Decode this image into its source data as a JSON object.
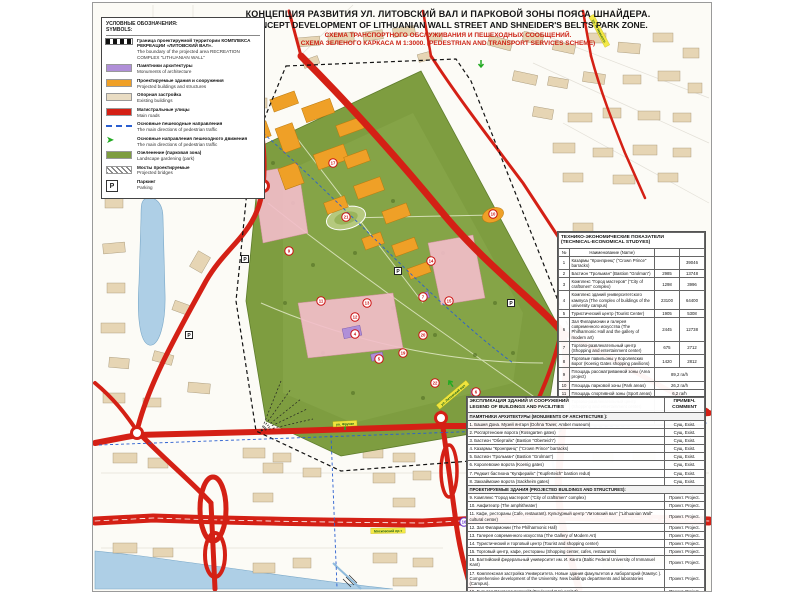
{
  "title": {
    "line1": "КОНЦЕПЦИЯ РАЗВИТИЯ УЛ. ЛИТОВСКИЙ ВАЛ И ПАРКОВОЙ ЗОНЫ ПОЯСА ШНАЙДЕРА.",
    "line2": "CONCEPT DEVELOPMENT OF LITHUANIAN WALL STREET AND SHNEIDER'S BELT'S PARK ZONE.",
    "line3": "СХЕМА ТРАНСПОРТНОГО ОБСЛУЖИВАНИЯ  И ПЕШЕХОДНЫХ  СООБЩЕНИЙ.",
    "line4": "СХЕМА ЗЕЛЕНОГО КАРКАСА  М 1:3000. (PEDESTRIAN AND TRANSPORT SERVICES SCHEME)"
  },
  "legend": {
    "header_ru": "УСЛОВНЫЕ ОБОЗНАЧЕНИЯ:",
    "header_en": "SYMBOLS:",
    "items": [
      {
        "type": "boundary",
        "ru": "Граница проектируемой территории КОМПЛЕКСА РЕКРЕАЦИИ «ЛИТОВСКИЙ ВАЛ».",
        "en": "The boundary of the projected area RECREATION COMPLEX \"LITHUANIAN WALL\""
      },
      {
        "type": "color",
        "color": "#b08fd8",
        "ru": "Памятники архитектуры",
        "en": "Monuments of architecture"
      },
      {
        "type": "color",
        "color": "#efa027",
        "ru": "Проектируемые здания и сооружения",
        "en": "Projected buildings and structures"
      },
      {
        "type": "color",
        "color": "#e9dcc3",
        "ru": "Опорная застройка",
        "en": "Existing buildings"
      },
      {
        "type": "color",
        "color": "#d42015",
        "ru": "Магистральные улицы",
        "en": "Main roads"
      },
      {
        "type": "bluedash",
        "ru": "Основные пешеходные направления",
        "en": "The main directions of pedestrian traffic"
      },
      {
        "type": "arrow",
        "ru": "Основные направления пешеходного движения",
        "en": "The main directions of pedestrian traffic"
      },
      {
        "type": "color",
        "color": "#7e9d40",
        "ru": "Озеленение (парковая зона)",
        "en": "Landscape gardening (park)"
      },
      {
        "type": "hatch",
        "ru": "Мосты проектируемые",
        "en": "Projected bridges"
      },
      {
        "type": "parking",
        "ru": "Паркинг",
        "en": "Parking"
      }
    ]
  },
  "tables": {
    "tech": {
      "title_ru": "ТЕХНИКО-ЭКОНОМИЧЕСКИЕ ПОКАЗАТЕЛИ",
      "title_en": "(TECHNICAL-ECONOMICAL STUDYES)",
      "col_num": "№",
      "col_name": "Наименование (Name)",
      "rows": [
        {
          "n": "1",
          "name": "Казармы \"Кронпринц\" (\"Crown Prince\" barracks)",
          "v1": "",
          "v2": "39046"
        },
        {
          "n": "2",
          "name": "Бастион \"Грольман\" (Bastion \"Grolman\")",
          "v1": "2985",
          "v2": "13748"
        },
        {
          "n": "3",
          "name": "Комплекс \"Город мастеров\" (\"City of craftsmen\" complex)",
          "v1": "1298",
          "v2": "3996"
        },
        {
          "n": "4",
          "name": "Комплекс зданий университетского кампуса (The complex of buildings of the university campus)",
          "v1": "23100",
          "v2": "64400"
        },
        {
          "n": "5",
          "name": "Туристический центр (Tourist Center)",
          "v1": "1905",
          "v2": "5308"
        },
        {
          "n": "6",
          "name": "Зал Филармонии и галерея современного искусства (The Philharmonic Hall and the gallery of modern art)",
          "v1": "2445",
          "v2": "12738"
        },
        {
          "n": "7",
          "name": "Торгово-развлекательный центр (Shopping and entertainment center)",
          "v1": "675",
          "v2": "2712"
        },
        {
          "n": "8",
          "name": "Торговые павильоны у Королевских ворот (Koenig Gates shopping pavilions)",
          "v1": "1420",
          "v2": "2812"
        },
        {
          "n": "9",
          "name": "Площадь рассматриваемой зоны (Area project)",
          "wide": true,
          "v2": "89,2 га/h"
        },
        {
          "n": "10",
          "name": "Площадь парковой зоны (Park areas)",
          "wide": true,
          "v2": "26,2 га/h"
        },
        {
          "n": "11",
          "name": "Площадь спортивной зоны (Sport areas)",
          "wide": true,
          "v2": "6,2 га/h"
        },
        {
          "n": "12",
          "name": "Торгово-развлекательный центр (Shopping and entertainment center)",
          "wide": true,
          "v2": "30,2 га/h"
        },
        {
          "n": "13",
          "name": "Количество парковочных мест (Quantity of parking lots)",
          "wide": true,
          "v2": "800 мест - 6 паркингов 800 lots / 6 parkings"
        }
      ]
    },
    "exp": {
      "title_ru": "ЭКСПЛИКАЦИЯ  ЗДАНИЙ  И СООРУЖЕНИЙ",
      "title_en": "LEGEND OF BUILDINGS AND FACILITIES",
      "col_comment": "ПРИМЕЧ. COMMENT",
      "rows": [
        {
          "t": "sec",
          "text": "ПАМЯТНИКИ АРХИТЕКТУРЫ  (MONUMENTS OF ARCHITECTURE ):"
        },
        {
          "t": "row",
          "name": "1. Башня Дона. Музей янтаря (Dohna Tower, Amber museum)",
          "c": "Сущ. Exist."
        },
        {
          "t": "row",
          "name": "2. Росгартенские ворота (Rossgarten gates)",
          "c": "Сущ. Exist."
        },
        {
          "t": "row",
          "name": "3. Бастион \"Обертайх\" (Bastion \"Oberteich\")",
          "c": "Сущ. Exist."
        },
        {
          "t": "row",
          "name": "4. Казармы \"Кронпринц\" (\"Crown Prince\" barracks)",
          "c": "Сущ. Exist."
        },
        {
          "t": "row",
          "name": "5. Бастион \"Грольман\" (Bastion \"Grolman\")",
          "c": "Сущ. Exist."
        },
        {
          "t": "row",
          "name": "6. Королевские ворота (Koenig gates)",
          "c": "Сущ. Exist."
        },
        {
          "t": "row",
          "name": "7. Редюит бастиона \"Купферайх\" (\"Kupferteich\" bastion redut)",
          "c": "Сущ. Exist."
        },
        {
          "t": "row",
          "name": "8. Закхаймские ворота (Sackheim gates)",
          "c": "Сущ. Exist."
        },
        {
          "t": "sec",
          "text": "ПРОЕКТИРУЕМЫЕ  ЗДАНИЯ  (PROJECTED BUILDINGS AND STRUCTURES):"
        },
        {
          "t": "row",
          "name": "9. Комплекс \"Город мастеров\" (\"City of craftsmen\" complex)",
          "c": "Проект. Project."
        },
        {
          "t": "row",
          "name": "10. Амфитеатр (The amphitheater)",
          "c": "Проект. Project."
        },
        {
          "t": "row",
          "name": "11. Кафе, рестораны (Cafe, restaurant). Культурный центр \"Литовский вал\" (\"Lithuanian Wall\" cultural center)",
          "c": "Проект. Project."
        },
        {
          "t": "row",
          "name": "12. Зал Филармонии (The Philharmonic Hall)",
          "c": "Проект. Project."
        },
        {
          "t": "row",
          "name": "13. Галерея современного искусства (The Gallery of Modern Art)",
          "c": "Проект. Project."
        },
        {
          "t": "row",
          "name": "14. Туристический и торговый центр (Tourist and shopping center)",
          "c": "Проект. Project."
        },
        {
          "t": "row",
          "name": "15. Торговый центр, кафе, рестораны (Shopping center, cafes, restaurants)",
          "c": "Проект. Project."
        },
        {
          "t": "row",
          "name": "16. Балтийский федеральный университет им. И. Канта (Baltic Federal University of Immanuel Kant)",
          "c": "Проект. Project."
        },
        {
          "t": "row",
          "name": "17. Комплексная застройка Университета. Новые здания факультетов и лабораторий (Кампус ). Comprehensive development of the University. New buildings departments and laboratories (Campus).",
          "c": "Проект. Project."
        },
        {
          "t": "row",
          "name": "19. Бульвар \"Университетский\" (Boulevard \"University\")",
          "c": "Проект. Project."
        },
        {
          "t": "row",
          "name": "20. Площадь \"Академическая\" с памятником. (Area \"Academic\" with a monument)",
          "c": "Проект. Project."
        },
        {
          "t": "row",
          "name": "21. Спортивный комплекс: (Стадион, теннисные корты, баскетбольные площадки, велосипедные дорожки ). Sports complex (Stadium, tennis courts, basketball courts, bike paths)",
          "c": "Проект. Project."
        },
        {
          "t": "row",
          "name": "22. Парковая зона  (Park)",
          "c": "Проект. Project."
        }
      ]
    }
  },
  "map": {
    "street_labels": [
      "ул. Фрунзе",
      "ул. Литовский вал",
      "ул. А. Невского",
      "Московский пр-т"
    ],
    "marker_numbers": [
      "1",
      "2",
      "3",
      "4",
      "5",
      "6",
      "7",
      "8",
      "9",
      "10",
      "11",
      "12",
      "13",
      "14",
      "15",
      "16",
      "17",
      "19",
      "20",
      "21",
      "22"
    ],
    "parking_label": "P"
  },
  "colors": {
    "road": "#d42015",
    "park": "#7e9d40",
    "projected": "#efa027",
    "monument": "#b08fd8",
    "existing": "#e6d5b4",
    "water": "#aecfe6",
    "pedestrian": "#2b5fd0",
    "arrow": "#22aa22",
    "label_bg": "#f4e93e"
  }
}
